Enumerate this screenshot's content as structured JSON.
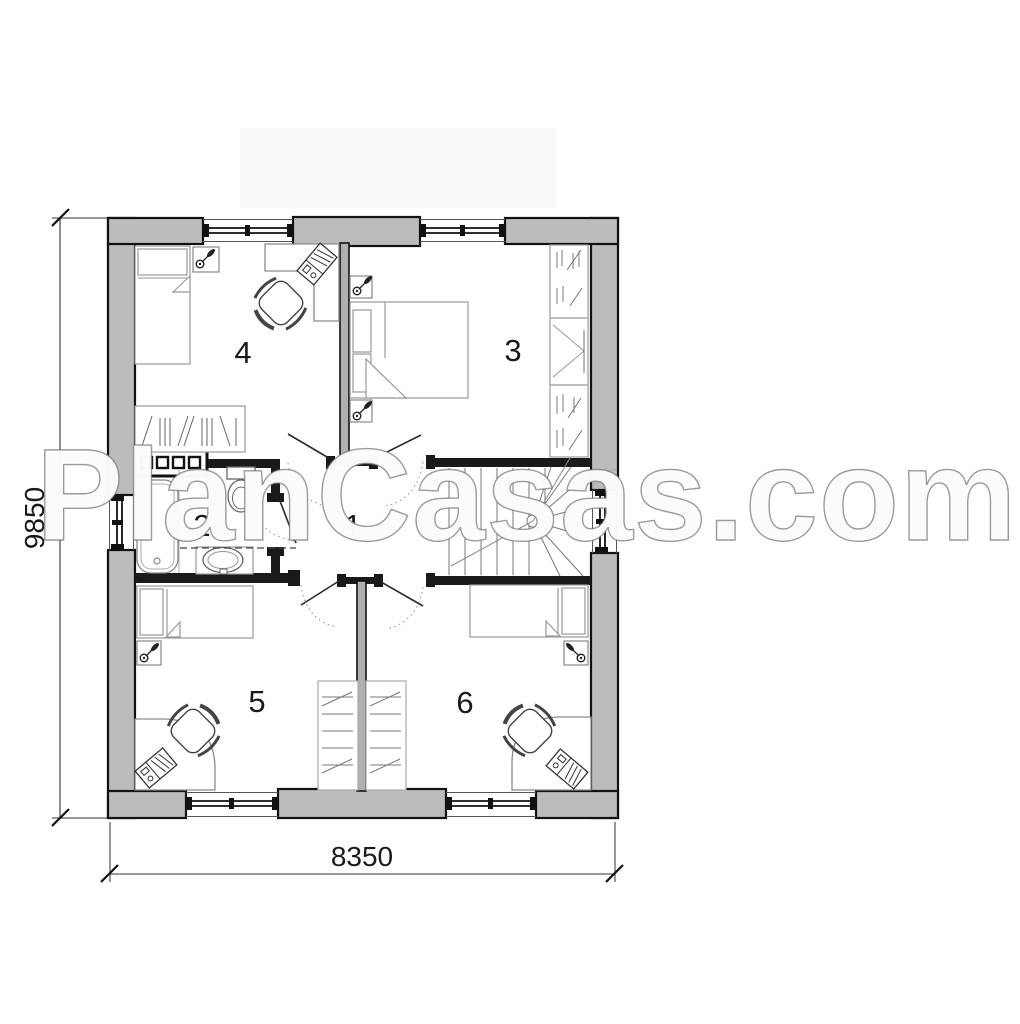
{
  "watermark": {
    "text": "PlanCasas.com"
  },
  "dimensions": {
    "left_height": "9850",
    "bottom_width": "8350"
  },
  "room_labels": [
    "1",
    "2",
    "3",
    "4",
    "5",
    "6"
  ],
  "colors": {
    "background": "#ffffff",
    "wall_fill": "#bcbcbc",
    "wall_outline": "#111111",
    "partition_dark": "#1a1a1a",
    "furniture_line": "#999999",
    "detail_line": "#333333",
    "stair_line": "#777777"
  }
}
